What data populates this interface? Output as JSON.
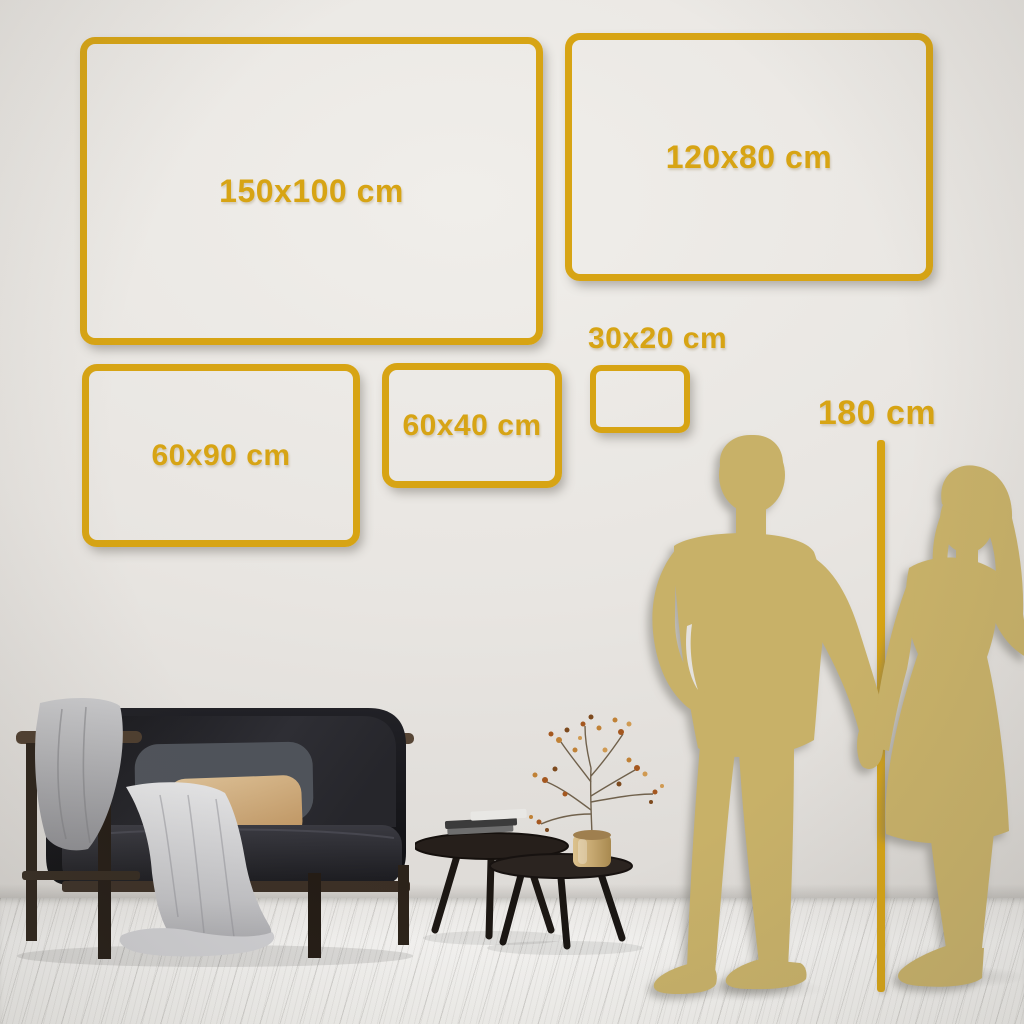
{
  "colors": {
    "frame_gold": "#D7A414",
    "silhouette_gold": "#C8B168",
    "wall": "#E7E4E0",
    "floor": "#F2F1EE"
  },
  "sizes": [
    {
      "label": "150x100 cm",
      "width_cm": 150,
      "height_cm": 100
    },
    {
      "label": "120x80 cm",
      "width_cm": 120,
      "height_cm": 80
    },
    {
      "label": "60x90 cm",
      "width_cm": 60,
      "height_cm": 90
    },
    {
      "label": "60x40 cm",
      "width_cm": 60,
      "height_cm": 40
    },
    {
      "label": "30x20 cm",
      "width_cm": 30,
      "height_cm": 20
    }
  ],
  "reference": {
    "label": "180 cm",
    "height_cm": 180,
    "subject": "couple-holding-hands-silhouette"
  },
  "objects": {
    "couple": "man-and-woman-holding-hands-silhouette",
    "sofa": "dark-velvet-sofa",
    "blanket": "gray-throw-blanket",
    "cushion": "gray-back-cushion",
    "pillow": "beige-lumbar-pillow",
    "tables": "round-nesting-coffee-tables",
    "books": "stacked-books",
    "vase": "gold-vase",
    "plant": "dried-flower-branches"
  }
}
